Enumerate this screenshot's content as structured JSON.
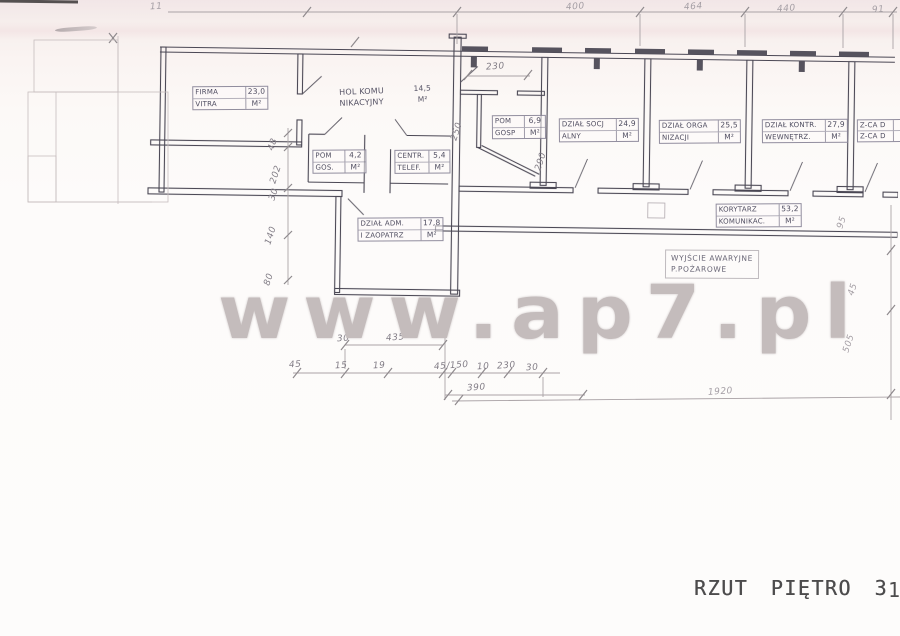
{
  "watermark": "www.ap7.pl",
  "caption": "RZUT PIĘTRO 3",
  "caption_fragment": "1",
  "rooms": [
    {
      "id": "firma-vitra",
      "name1": "FIRMA",
      "name2": "VITRA",
      "area": "23,0",
      "unit": "M²"
    },
    {
      "id": "hol-komunikacyjny",
      "name1": "HOL KOMU",
      "name2": "NIKACYJNY",
      "area": "14,5",
      "unit": "M²"
    },
    {
      "id": "pom-gos",
      "name1": "POM",
      "name2": "GOS.",
      "area": "4,2",
      "unit": "M²"
    },
    {
      "id": "centrala-telef",
      "name1": "CENTR.",
      "name2": "TELEF.",
      "area": "5,4",
      "unit": "M²"
    },
    {
      "id": "dzial-adm-zaopatrz",
      "name1": "DZIAŁ ADM.",
      "name2": "I ZAOPATRZ",
      "area": "17,8",
      "unit": "M²"
    },
    {
      "id": "pom-gosp",
      "name1": "POM",
      "name2": "GOSP",
      "area": "6,9",
      "unit": "M²"
    },
    {
      "id": "dzial-socjalny",
      "name1": "DZIAŁ SOCJ",
      "name2": "ALNY",
      "area": "24,9",
      "unit": "M²"
    },
    {
      "id": "dzial-organizacji",
      "name1": "DZIAŁ ORGA",
      "name2": "NIZACJI",
      "area": "25,5",
      "unit": "M²"
    },
    {
      "id": "dzial-kontr-wewnetrz",
      "name1": "DZIAŁ KONTR.",
      "name2": "WEWNĘTRZ.",
      "area": "27,9",
      "unit": "M²"
    },
    {
      "id": "zca-dyrektora",
      "name1": "Z-CA D",
      "name2": "Z-CA D",
      "area": "",
      "unit": ""
    },
    {
      "id": "korytarz",
      "name1": "KORYTARZ",
      "name2": "KOMUNIKAC.",
      "area": "53,2",
      "unit": "M²"
    }
  ],
  "annotations": {
    "exit1": "WYJŚCIE AWARYJNE",
    "exit2": "P.POŻAROWE"
  },
  "dims": {
    "top": [
      "400",
      "464",
      "440",
      "91"
    ],
    "top_left_corner": "11",
    "left": [
      "48",
      "202",
      "30",
      "140",
      "80"
    ],
    "mid_230": "230",
    "mid_250": "250",
    "mid_290": "290",
    "row1": [
      "30",
      "435"
    ],
    "row2": [
      "45",
      "15",
      "19",
      "45/150",
      "10",
      "230",
      "30"
    ],
    "row3": "390",
    "long_bottom": "1920",
    "right": [
      "95",
      "45",
      "505"
    ]
  },
  "colors": {
    "paper_tint": "#f6eeec",
    "wall_ink": "#4a4754",
    "dim_pencil": "#8f8a8d",
    "watermark_gray": "#c4bcbc",
    "stamp_ink": "#4c4b4c"
  }
}
